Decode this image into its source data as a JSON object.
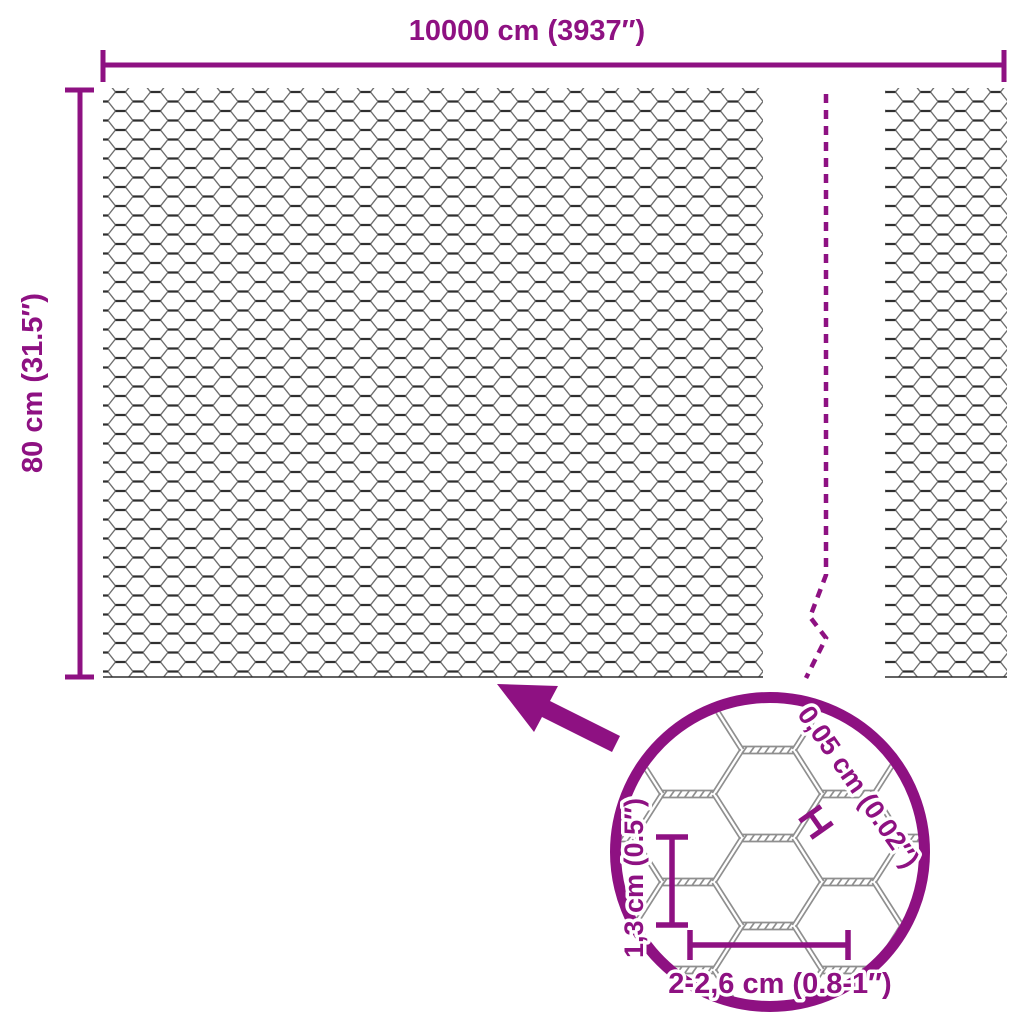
{
  "title": "Hexagonal wire mesh roll dimension diagram",
  "colors": {
    "accent": "#8E1182",
    "wire": "#6E6E6E",
    "wire_dark": "#2F2F2F",
    "wire_zoom": "#8F8F8F",
    "background": "#FFFFFF"
  },
  "dimension_labels": {
    "width": "10000 cm (3937″)",
    "height": "80 cm (31.5″)"
  },
  "detail_labels": {
    "wire_thickness": "0,05 cm (0.02″)",
    "mesh_height": "1,3 cm (0.5″)",
    "mesh_width": "2-2,6 cm (0.8-1″)"
  }
}
